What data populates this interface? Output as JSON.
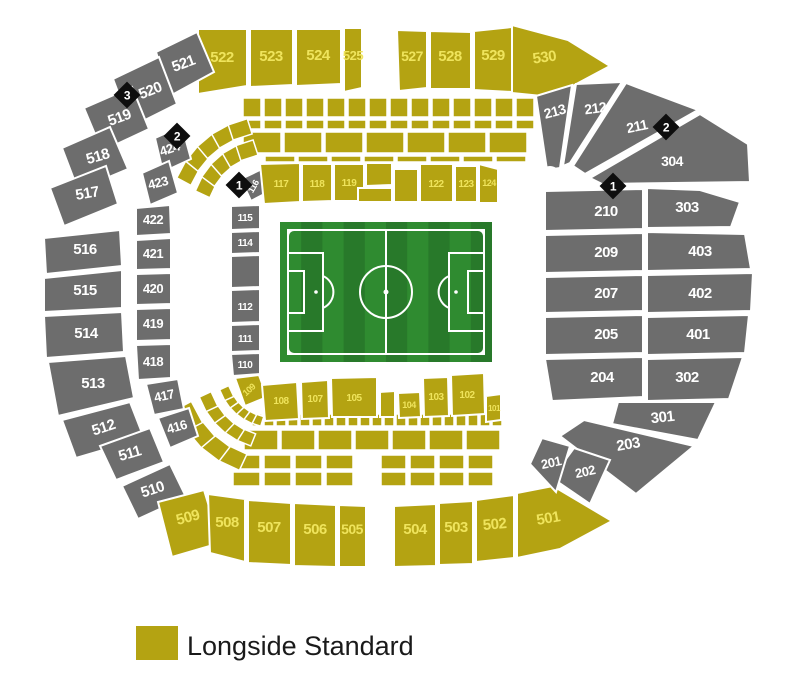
{
  "legend": {
    "label": "Longside Standard"
  },
  "colors": {
    "standard": "#b4a312",
    "standard_label": "#efe45c",
    "unavailable": "#6d6d6d",
    "unavailable_label": "#ffffff",
    "marker_bg": "#0e0e0e",
    "marker_label": "#ffffff",
    "pitch_light": "#2f8b30",
    "pitch_dark": "#28792a",
    "pitch_lines": "#ffffff",
    "legend_text": "#1a1a1a"
  },
  "pitch": {
    "x": 280,
    "y": 222,
    "w": 212,
    "h": 140,
    "stripes": 10
  },
  "hub": {
    "x": 550,
    "y": 177,
    "r": 11
  },
  "markers": [
    {
      "label": "3",
      "x": 127,
      "y": 95
    },
    {
      "label": "2",
      "x": 177,
      "y": 136
    },
    {
      "label": "1",
      "x": 239,
      "y": 185
    },
    {
      "label": "2",
      "x": 666,
      "y": 127
    },
    {
      "label": "1",
      "x": 613,
      "y": 186
    }
  ],
  "decor": {
    "rows": [
      {
        "x": 243,
        "y": 98,
        "w": 18,
        "h": 19,
        "gap": 3,
        "n": 14
      },
      {
        "x": 243,
        "y": 120,
        "w": 18,
        "h": 9,
        "gap": 3,
        "n": 14
      },
      {
        "x": 243,
        "y": 132,
        "w": 38,
        "h": 21,
        "gap": 3,
        "n": 7
      },
      {
        "x": 265,
        "y": 156,
        "w": 30,
        "h": 6,
        "gap": 3,
        "n": 8
      },
      {
        "x": 252,
        "y": 414,
        "w": 10,
        "h": 12,
        "gap": 2,
        "n": 21
      },
      {
        "x": 244,
        "y": 430,
        "w": 34,
        "h": 20,
        "gap": 3,
        "n": 7
      },
      {
        "x": 233,
        "y": 455,
        "w": 27,
        "h": 14,
        "gap": 4,
        "n": 4
      },
      {
        "x": 233,
        "y": 472,
        "w": 27,
        "h": 14,
        "gap": 4,
        "n": 4
      },
      {
        "x": 381,
        "y": 455,
        "w": 25,
        "h": 14,
        "gap": 4,
        "n": 4
      },
      {
        "x": 381,
        "y": 472,
        "w": 25,
        "h": 14,
        "gap": 4,
        "n": 4
      }
    ],
    "fans": [
      {
        "cx": 268,
        "cy": 215,
        "r": 68,
        "a0": 205,
        "a1": 252,
        "n": 5,
        "w": 18,
        "h": 16
      },
      {
        "cx": 268,
        "cy": 215,
        "r": 90,
        "a0": 208,
        "a1": 252,
        "n": 5,
        "w": 20,
        "h": 16
      },
      {
        "cx": 272,
        "cy": 372,
        "r": 50,
        "a0": 108,
        "a1": 155,
        "n": 6,
        "w": 12,
        "h": 10
      },
      {
        "cx": 272,
        "cy": 372,
        "r": 70,
        "a0": 112,
        "a1": 155,
        "n": 5,
        "w": 16,
        "h": 13
      },
      {
        "cx": 272,
        "cy": 372,
        "r": 94,
        "a0": 115,
        "a1": 152,
        "n": 4,
        "w": 24,
        "h": 18
      }
    ]
  },
  "sections": [
    {
      "label": "522",
      "type": "standard",
      "pts": "198,29 247,29 247,86 198,94",
      "lx": 222,
      "ly": 62
    },
    {
      "label": "523",
      "type": "standard",
      "pts": "250,29 293,29 293,85 250,87",
      "lx": 271,
      "ly": 61
    },
    {
      "label": "524",
      "type": "standard",
      "pts": "296,29 341,29 341,84 296,86",
      "lx": 318,
      "ly": 60
    },
    {
      "label": "525",
      "type": "standard",
      "pts": "344,28 362,28 362,88 344,92",
      "lx": 353,
      "ly": 60,
      "fs": 13
    },
    {
      "label": "527",
      "type": "standard",
      "pts": "397,30 427,31 427,88 399,91",
      "lx": 412,
      "ly": 61,
      "fs": 14
    },
    {
      "label": "528",
      "type": "standard",
      "pts": "430,31 471,32 471,89 430,89",
      "lx": 450,
      "ly": 61
    },
    {
      "label": "529",
      "type": "standard",
      "pts": "474,31 512,27 512,92 474,90",
      "lx": 493,
      "ly": 60
    },
    {
      "label": "530",
      "type": "standard",
      "pts": "512,25 568,40 610,66 552,97 512,93",
      "lx": 545,
      "ly": 62,
      "rot": -8
    },
    {
      "label": "521",
      "type": "unavailable",
      "pts": "156,52 197,32 214,72 170,96",
      "lx": 185,
      "ly": 68,
      "rot": -20
    },
    {
      "label": "520",
      "type": "unavailable",
      "pts": "113,79 159,57 177,104 131,127",
      "lx": 152,
      "ly": 95,
      "rot": -22
    },
    {
      "label": "519",
      "type": "unavailable",
      "pts": "84,108 132,87 149,129 102,151",
      "lx": 121,
      "ly": 122,
      "rot": -20
    },
    {
      "label": "518",
      "type": "unavailable",
      "pts": "62,148 110,127 128,169 78,190",
      "lx": 99,
      "ly": 161,
      "rot": -16
    },
    {
      "label": "517",
      "type": "unavailable",
      "pts": "50,188 106,166 118,204 64,226",
      "lx": 88,
      "ly": 198,
      "rot": -10
    },
    {
      "label": "516",
      "type": "unavailable",
      "pts": "44,238 120,230 122,266 46,274",
      "lx": 85,
      "ly": 254
    },
    {
      "label": "515",
      "type": "unavailable",
      "pts": "44,278 122,270 122,308 44,312",
      "lx": 85,
      "ly": 295
    },
    {
      "label": "514",
      "type": "unavailable",
      "pts": "44,316 122,312 124,352 46,358",
      "lx": 86,
      "ly": 338
    },
    {
      "label": "513",
      "type": "unavailable",
      "pts": "48,362 126,356 134,398 58,416",
      "lx": 93,
      "ly": 388
    },
    {
      "label": "512",
      "type": "unavailable",
      "pts": "62,420 130,402 144,438 76,458",
      "lx": 105,
      "ly": 432,
      "rot": -18
    },
    {
      "label": "511",
      "type": "unavailable",
      "pts": "100,446 150,428 164,462 116,480",
      "lx": 131,
      "ly": 458,
      "rot": -16
    },
    {
      "label": "510",
      "type": "unavailable",
      "pts": "122,486 170,464 186,497 138,519",
      "lx": 154,
      "ly": 494,
      "rot": -18
    },
    {
      "label": "509",
      "type": "standard",
      "pts": "158,502 204,490 220,543 172,557",
      "lx": 189,
      "ly": 522,
      "rot": -15
    },
    {
      "label": "508",
      "type": "standard",
      "pts": "208,494 245,499 245,562 210,553",
      "lx": 227,
      "ly": 527
    },
    {
      "label": "507",
      "type": "standard",
      "pts": "248,500 291,503 291,565 248,563",
      "lx": 269,
      "ly": 532
    },
    {
      "label": "506",
      "type": "standard",
      "pts": "294,503 336,505 336,567 294,566",
      "lx": 315,
      "ly": 534
    },
    {
      "label": "505",
      "type": "standard",
      "pts": "339,505 366,506 366,567 339,567",
      "lx": 352,
      "ly": 534,
      "fs": 14
    },
    {
      "label": "504",
      "type": "standard",
      "pts": "394,506 436,504 436,566 394,567",
      "lx": 415,
      "ly": 534
    },
    {
      "label": "503",
      "type": "standard",
      "pts": "439,503 473,501 473,564 439,565",
      "lx": 456,
      "ly": 532
    },
    {
      "label": "502",
      "type": "standard",
      "pts": "476,500 514,495 514,558 476,562",
      "lx": 495,
      "ly": 529,
      "rot": -5
    },
    {
      "label": "501",
      "type": "standard",
      "pts": "517,493 553,486 612,521 560,549 517,558",
      "lx": 549,
      "ly": 523,
      "rot": -10
    },
    {
      "label": "213",
      "type": "unavailable",
      "pts": "536,96 572,85 560,168 547,170",
      "lx": 556,
      "ly": 116,
      "rot": -15,
      "fs": 14
    },
    {
      "label": "212",
      "type": "unavailable",
      "pts": "576,84 622,82 570,163 563,166",
      "lx": 596,
      "ly": 113,
      "rot": -8,
      "fs": 14
    },
    {
      "label": "211",
      "type": "unavailable",
      "pts": "626,83 698,110 585,174 573,166",
      "lx": 638,
      "ly": 131,
      "rot": -12,
      "fs": 14
    },
    {
      "label": "304",
      "type": "unavailable",
      "pts": "590,178 700,114 748,144 750,182 602,184",
      "lx": 672,
      "ly": 166,
      "fs": 14
    },
    {
      "label": "210",
      "type": "unavailable",
      "pts": "545,191 643,189 643,229 545,231",
      "lx": 606,
      "ly": 216
    },
    {
      "label": "303",
      "type": "unavailable",
      "pts": "647,188 700,190 740,202 731,227 647,228",
      "lx": 687,
      "ly": 212
    },
    {
      "label": "209",
      "type": "unavailable",
      "pts": "545,235 643,233 643,271 545,273",
      "lx": 606,
      "ly": 257
    },
    {
      "label": "403",
      "type": "unavailable",
      "pts": "647,232 745,234 751,269 647,271",
      "lx": 700,
      "ly": 256
    },
    {
      "label": "207",
      "type": "unavailable",
      "pts": "545,277 643,275 643,311 545,313",
      "lx": 606,
      "ly": 298
    },
    {
      "label": "402",
      "type": "unavailable",
      "pts": "647,275 753,273 751,311 647,313",
      "lx": 700,
      "ly": 298
    },
    {
      "label": "205",
      "type": "unavailable",
      "pts": "545,317 643,315 643,353 545,355",
      "lx": 606,
      "ly": 339
    },
    {
      "label": "401",
      "type": "unavailable",
      "pts": "647,317 749,315 745,353 647,355",
      "lx": 698,
      "ly": 339
    },
    {
      "label": "204",
      "type": "unavailable",
      "pts": "545,359 643,357 643,397 552,401",
      "lx": 602,
      "ly": 382
    },
    {
      "label": "302",
      "type": "unavailable",
      "pts": "647,359 743,357 729,399 647,401",
      "lx": 687,
      "ly": 382
    },
    {
      "label": "301",
      "type": "unavailable",
      "pts": "618,402 716,402 698,440 612,424",
      "lx": 663,
      "ly": 422,
      "rot": -6
    },
    {
      "label": "203",
      "type": "unavailable",
      "pts": "584,420 694,446 636,494 560,436",
      "lx": 629,
      "ly": 449,
      "rot": -10
    },
    {
      "label": "202",
      "type": "unavailable",
      "pts": "574,448 610,460 590,504 552,478",
      "lx": 586,
      "ly": 476,
      "rot": -12,
      "fs": 13
    },
    {
      "label": "201",
      "type": "unavailable",
      "pts": "542,438 570,446 556,492 530,464",
      "lx": 552,
      "ly": 467,
      "rot": -12,
      "fs": 13
    },
    {
      "label": "424",
      "type": "unavailable",
      "pts": "155,138 182,126 191,159 163,172",
      "lx": 171,
      "ly": 153,
      "rot": -18,
      "fs": 13
    },
    {
      "label": "423",
      "type": "unavailable",
      "pts": "142,173 169,161 178,193 150,205",
      "lx": 159,
      "ly": 187,
      "rot": -14,
      "fs": 13
    },
    {
      "label": "422",
      "type": "unavailable",
      "pts": "136,208 170,205 171,234 136,236",
      "lx": 153,
      "ly": 224,
      "fs": 13
    },
    {
      "label": "421",
      "type": "unavailable",
      "pts": "136,240 171,238 171,269 136,270",
      "lx": 153,
      "ly": 258,
      "fs": 13
    },
    {
      "label": "420",
      "type": "unavailable",
      "pts": "136,274 171,273 171,304 136,305",
      "lx": 153,
      "ly": 293,
      "fs": 13
    },
    {
      "label": "419",
      "type": "unavailable",
      "pts": "136,309 171,308 171,340 136,341",
      "lx": 153,
      "ly": 328,
      "fs": 13
    },
    {
      "label": "418",
      "type": "unavailable",
      "pts": "136,345 171,344 171,378 138,380",
      "lx": 153,
      "ly": 366,
      "fs": 13
    },
    {
      "label": "417",
      "type": "unavailable",
      "pts": "146,384 178,379 184,409 154,415",
      "lx": 165,
      "ly": 400,
      "rot": -12,
      "fs": 13
    },
    {
      "label": "416",
      "type": "unavailable",
      "pts": "158,418 189,408 198,436 170,448",
      "lx": 178,
      "ly": 431,
      "rot": -16,
      "fs": 13
    },
    {
      "label": "116",
      "type": "unavailable",
      "pts": "241,179 262,169 272,190 251,201",
      "lx": 256,
      "ly": 188,
      "rot": -60,
      "fs": 9
    },
    {
      "label": "115",
      "type": "unavailable",
      "pts": "231,206 260,205 260,229 231,230",
      "lx": 245,
      "ly": 221,
      "fs": 10
    },
    {
      "label": "114",
      "type": "unavailable",
      "pts": "231,232 260,231 260,253 231,254",
      "lx": 245,
      "ly": 246,
      "fs": 10
    },
    {
      "label": "",
      "type": "unavailable",
      "pts": "231,256 260,255 260,287 231,288"
    },
    {
      "label": "112",
      "type": "unavailable",
      "pts": "231,290 260,289 260,322 231,323",
      "lx": 245,
      "ly": 310,
      "fs": 10
    },
    {
      "label": "111",
      "type": "unavailable",
      "pts": "231,325 260,324 260,351 231,352",
      "lx": 245,
      "ly": 342,
      "fs": 10
    },
    {
      "label": "110",
      "type": "unavailable",
      "pts": "231,354 260,353 260,374 233,376",
      "lx": 245,
      "ly": 368,
      "fs": 10
    },
    {
      "label": "117",
      "type": "standard",
      "pts": "260,164 300,163 300,202 264,204",
      "lx": 281,
      "ly": 187,
      "fs": 10
    },
    {
      "label": "118",
      "type": "standard",
      "pts": "302,164 332,164 332,201 302,202",
      "lx": 317,
      "ly": 187,
      "fs": 10
    },
    {
      "label": "119",
      "type": "standard",
      "pts": "334,164 364,164 364,201 334,201",
      "lx": 349,
      "ly": 186,
      "fs": 10
    },
    {
      "label": "",
      "type": "standard",
      "pts": "366,163 392,163 392,185 366,186"
    },
    {
      "label": "",
      "type": "standard",
      "pts": "358,188 392,188 392,202 358,202"
    },
    {
      "label": "",
      "type": "standard",
      "pts": "394,169 418,169 418,202 394,202"
    },
    {
      "label": "122",
      "type": "standard",
      "pts": "420,164 453,164 453,202 420,202",
      "lx": 436,
      "ly": 187,
      "fs": 10
    },
    {
      "label": "123",
      "type": "standard",
      "pts": "455,166 477,166 477,202 455,202",
      "lx": 466,
      "ly": 187,
      "fs": 10
    },
    {
      "label": "124",
      "type": "standard",
      "pts": "479,164 498,169 498,203 479,203",
      "lx": 489,
      "ly": 186,
      "fs": 9
    },
    {
      "label": "109",
      "type": "standard",
      "pts": "235,378 259,375 267,397 245,406",
      "lx": 251,
      "ly": 392,
      "rot": -42,
      "fs": 9
    },
    {
      "label": "108",
      "type": "standard",
      "pts": "262,385 297,382 299,419 265,421",
      "lx": 281,
      "ly": 404,
      "fs": 10
    },
    {
      "label": "107",
      "type": "standard",
      "pts": "301,382 328,380 329,418 302,419",
      "lx": 315,
      "ly": 402,
      "fs": 10
    },
    {
      "label": "105",
      "type": "standard",
      "pts": "331,378 377,377 377,417 332,417",
      "lx": 354,
      "ly": 401,
      "fs": 10
    },
    {
      "label": "",
      "type": "standard",
      "pts": "380,392 395,391 395,417 380,417"
    },
    {
      "label": "104",
      "type": "standard",
      "pts": "398,393 420,392 421,417 399,418",
      "lx": 409,
      "ly": 408,
      "fs": 9
    },
    {
      "label": "103",
      "type": "standard",
      "pts": "423,378 448,377 449,416 424,417",
      "lx": 436,
      "ly": 400,
      "fs": 10
    },
    {
      "label": "102",
      "type": "standard",
      "pts": "451,375 484,373 485,414 452,416",
      "lx": 467,
      "ly": 398,
      "fs": 10
    },
    {
      "label": "101",
      "type": "standard",
      "pts": "486,396 501,394 501,420 486,422",
      "lx": 494,
      "ly": 411,
      "fs": 8
    }
  ]
}
